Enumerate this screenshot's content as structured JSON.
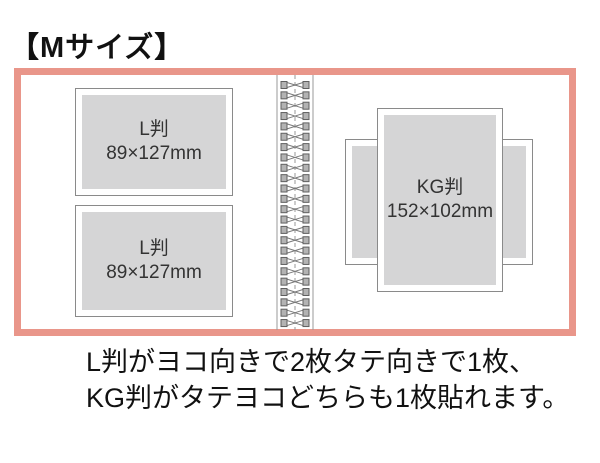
{
  "page": {
    "title": "【Mサイズ】"
  },
  "album": {
    "left_page": {
      "slots": [
        {
          "name": "L判",
          "size": "89×127mm"
        },
        {
          "name": "L判",
          "size": "89×127mm"
        }
      ]
    },
    "binding": {
      "ring_count": 24
    },
    "right_page": {
      "portrait_slot": {
        "name": "KG判",
        "size": "152×102mm"
      }
    }
  },
  "caption": {
    "line1": "L判がヨコ向きで2枚タテ向きで1枚、",
    "line2": "KG判がタテヨコどちらも1枚貼れます。"
  },
  "colors": {
    "frame": "#E9968A",
    "photo_area": "#D5D5D6",
    "slot_border": "#8A8A8A",
    "text": "#1A1A1A"
  }
}
